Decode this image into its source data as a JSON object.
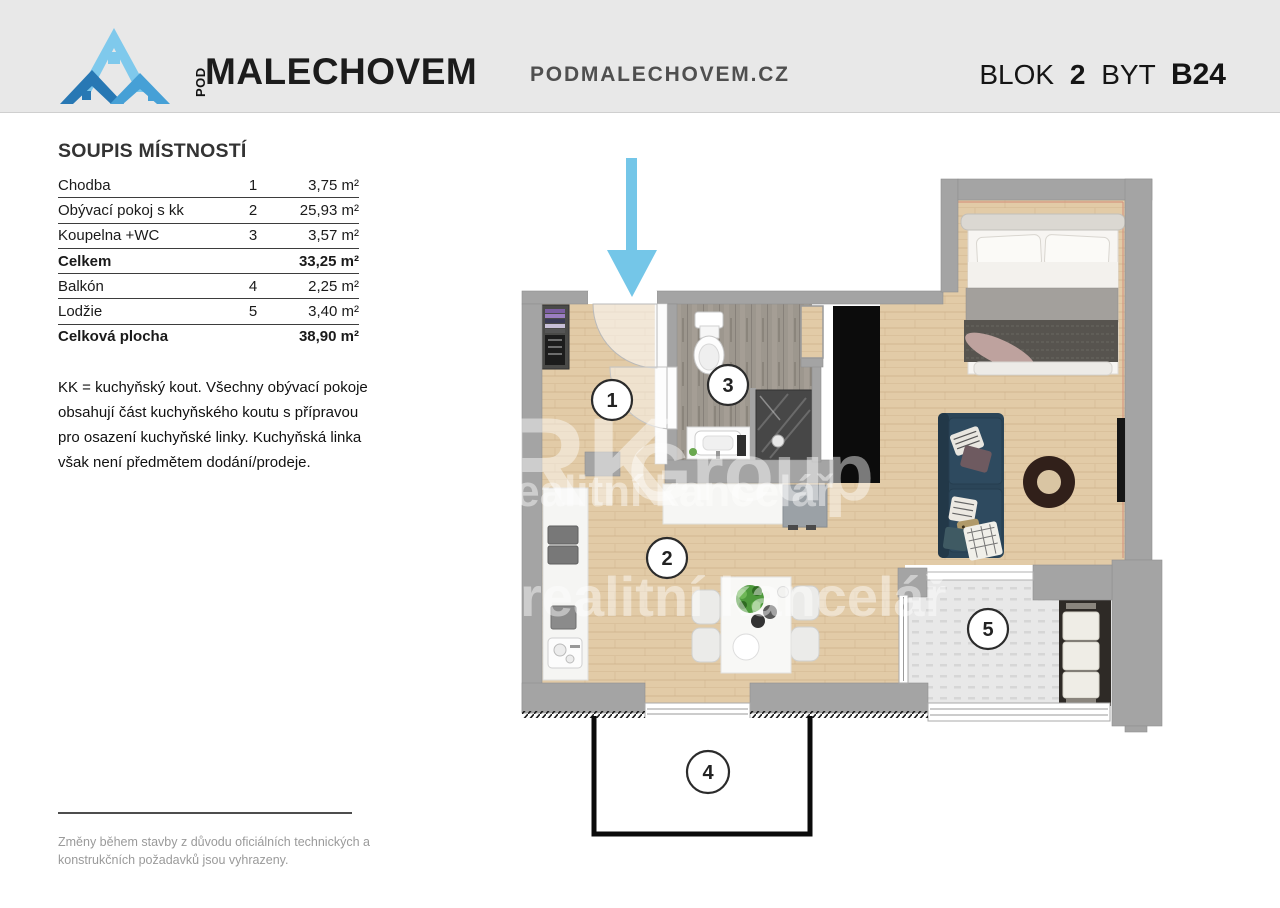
{
  "header": {
    "brand": {
      "pod": "POD",
      "name": "MALECHOVEM"
    },
    "website": "PODMALECHOVEM.CZ",
    "unit": {
      "blok_label": "BLOK",
      "blok_value": "2",
      "byt_label": "BYT",
      "byt_value": "B24"
    }
  },
  "room_list": {
    "title": "SOUPIS MÍSTNOSTÍ",
    "rows": [
      {
        "name": "Chodba",
        "number": "1",
        "area": "3,75 m²",
        "bold": false
      },
      {
        "name": "Obývací pokoj s kk",
        "number": "2",
        "area": "25,93 m²",
        "bold": false
      },
      {
        "name": "Koupelna +WC",
        "number": "3",
        "area": "3,57 m²",
        "bold": false
      },
      {
        "name": "Celkem",
        "number": "",
        "area": "33,25 m²",
        "bold": true
      },
      {
        "name": "Balkón",
        "number": "4",
        "area": "2,25 m²",
        "bold": false
      },
      {
        "name": "Lodžie",
        "number": "5",
        "area": "3,40 m²",
        "bold": false
      },
      {
        "name": "Celková plocha",
        "number": "",
        "area": "38,90 m²",
        "bold": true
      }
    ],
    "note": "KK = kuchyňský kout. Všechny obývací pokoje obsahují část kuchyňského koutu s přípravou pro osazení kuchyňské linky. Kuchyňská linka však není předmětem dodání/prodeje."
  },
  "plan": {
    "room_labels": {
      "chodba": "1",
      "obyvaci_pokoj": "2",
      "koupelna": "3",
      "balkon": "4",
      "lodzie": "5"
    },
    "watermark": {
      "line1": "RK",
      "line2": "Group",
      "line3": "realitní kancelář"
    },
    "colors": {
      "wall": "#a4a4a4",
      "wood_floor": "#e2cba7",
      "bath_tile": "#9d978e",
      "loggia_tile": "#e8e8e8",
      "arrow_blue": "#74c6e8",
      "sofa_blue": "#2b4558"
    }
  },
  "footer": {
    "disclaimer": "Změny během stavby z důvodu oficiálních technických a konstrukčních požadavků jsou vyhrazeny."
  }
}
